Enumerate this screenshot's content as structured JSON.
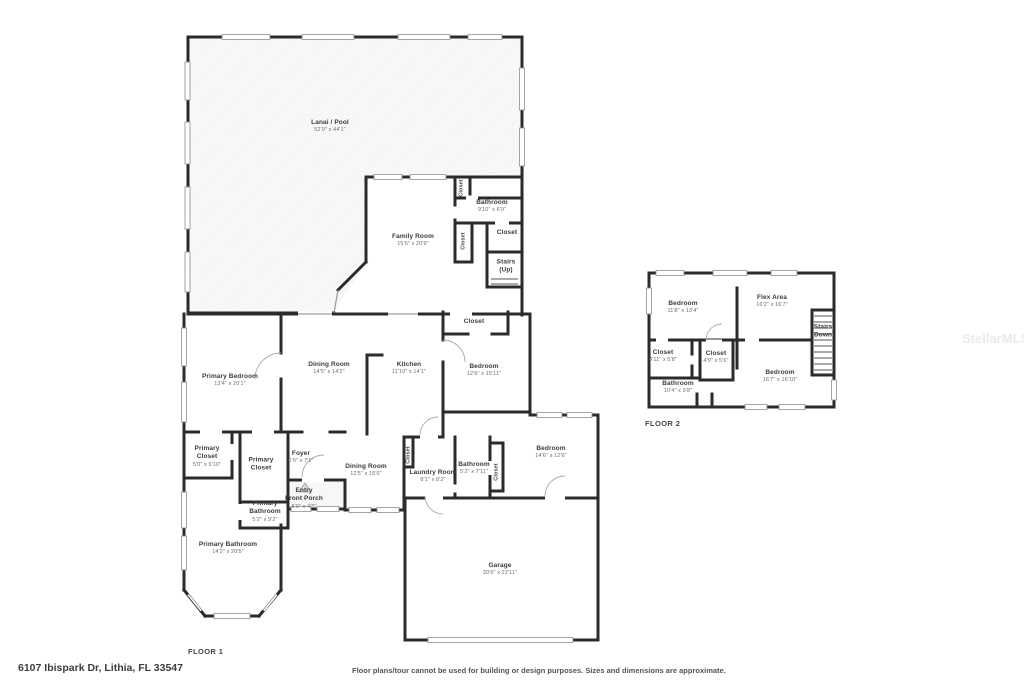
{
  "page": {
    "address": "6107 Ibispark Dr, Lithia, FL 33547",
    "disclaimer": "Floor plans/tour cannot be used for building or design purposes. Sizes and dimensions are approximate.",
    "watermark": "StellarMLS"
  },
  "floor1": {
    "label": "FLOOR 1",
    "rooms": {
      "lanai": {
        "name": "Lanai / Pool",
        "dims": "52'9\" x 44'1\""
      },
      "family": {
        "name": "Family Room",
        "dims": "15'6\" x 20'9\""
      },
      "bathroom_hall": {
        "name": "Bathroom",
        "dims": "9'10\" x 6'9\""
      },
      "closet_hall_top": {
        "name": "Closet"
      },
      "closet_hall_mid": {
        "name": "Closet"
      },
      "closet_hall_room": {
        "name": "Closet"
      },
      "stairs_up": {
        "name": "Stairs",
        "name2": "(Up)"
      },
      "dining1": {
        "name": "Dining Room",
        "dims": "14'5\" x 14'2\""
      },
      "kitchen": {
        "name": "Kitchen",
        "dims": "11'10\" x 14'1\""
      },
      "closet_bedroom": {
        "name": "Closet"
      },
      "bedroom_mid": {
        "name": "Bedroom",
        "dims": "12'6\" x 15'11\""
      },
      "primary_bedroom": {
        "name": "Primary Bedroom",
        "dims": "13'4\" x 20'1\""
      },
      "primary_closet1": {
        "name": "Primary",
        "name2": "Closet",
        "dims": "5'0\" x 9'10\""
      },
      "primary_closet2": {
        "name": "Primary",
        "name2": "Closet"
      },
      "foyer": {
        "name": "Foyer",
        "dims": "6'9\" x 7'1\""
      },
      "entry_porch": {
        "name": "Entry",
        "name2": "Front Porch",
        "dims": "8'9\" x 4'5\""
      },
      "primary_bath_small": {
        "name": "Primary",
        "name2": "Bathroom",
        "dims": "5'2\" x 9'2\""
      },
      "primary_bath": {
        "name": "Primary Bathroom",
        "dims": "14'2\" x 20'5\""
      },
      "dining2": {
        "name": "Dining Room",
        "dims": "12'5\" x 15'6\""
      },
      "closet_laundry": {
        "name": "Closet"
      },
      "laundry": {
        "name": "Laundry Room",
        "dims": "8'1\" x 8'2\""
      },
      "bathroom2": {
        "name": "Bathroom",
        "dims": "5'2\" x 7'11\""
      },
      "closet_bed2": {
        "name": "Closet"
      },
      "bedroom2": {
        "name": "Bedroom",
        "dims": "14'6\" x 12'6\""
      },
      "garage": {
        "name": "Garage",
        "dims": "20'6\" x 22'11\""
      }
    }
  },
  "floor2": {
    "label": "FLOOR 2",
    "rooms": {
      "bedroom3": {
        "name": "Bedroom",
        "dims": "11'8\" x 13'4\""
      },
      "flex": {
        "name": "Flex Area",
        "dims": "16'2\" x 16'7\""
      },
      "stairs_down": {
        "name": "Stairs",
        "name2": "(Down)"
      },
      "closet_f2_left": {
        "name": "Closet",
        "dims": "4'11\" x 5'8\""
      },
      "closet_f2_mid": {
        "name": "Closet",
        "dims": "4'9\" x 5'6\""
      },
      "bathroom3": {
        "name": "Bathroom",
        "dims": "10'4\" x 9'8\""
      },
      "bedroom4": {
        "name": "Bedroom",
        "dims": "16'7\" x 16'10\""
      }
    }
  }
}
